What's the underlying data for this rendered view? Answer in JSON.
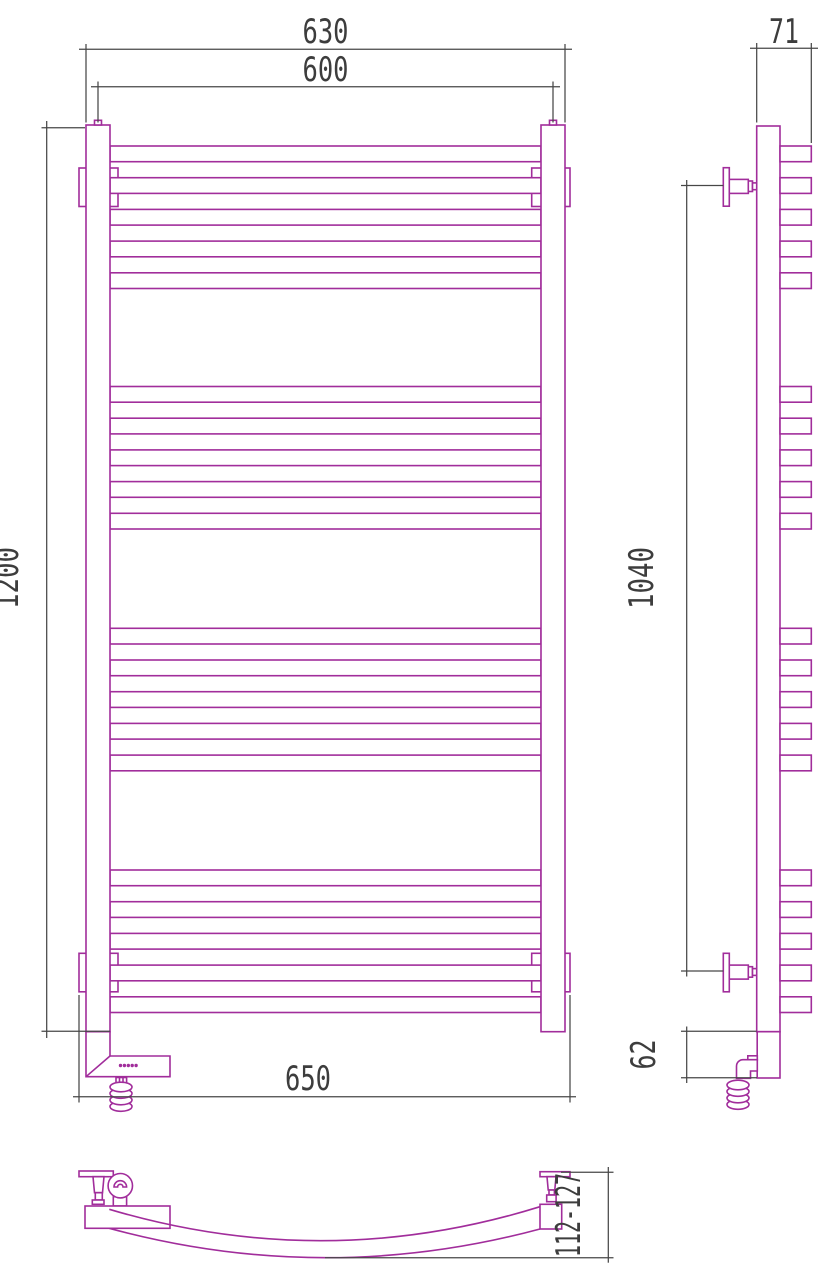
{
  "page": {
    "background": "#ffffff"
  },
  "drawing": {
    "title": "Curved heated towel rail - dimensional drawing, three orthographic views",
    "stroke_color": "#A12D9B",
    "dimension_color": "#3D3D3D",
    "views": {
      "front": "front view with electric heating element and coiled power cable",
      "side": "side view with wall brackets",
      "plan": "top plan view showing curved rung bow"
    },
    "rungs": {
      "groups": 4,
      "rungs_per_group": 5,
      "total": 20
    }
  },
  "dims": {
    "front_overall_width": "630",
    "front_center_width": "600",
    "front_height": "1200",
    "front_width_with_brackets": "650",
    "side_depth": "71",
    "side_bracket_span": "1040",
    "side_bottom_section": "62",
    "plan_depth_range": "112-127"
  }
}
